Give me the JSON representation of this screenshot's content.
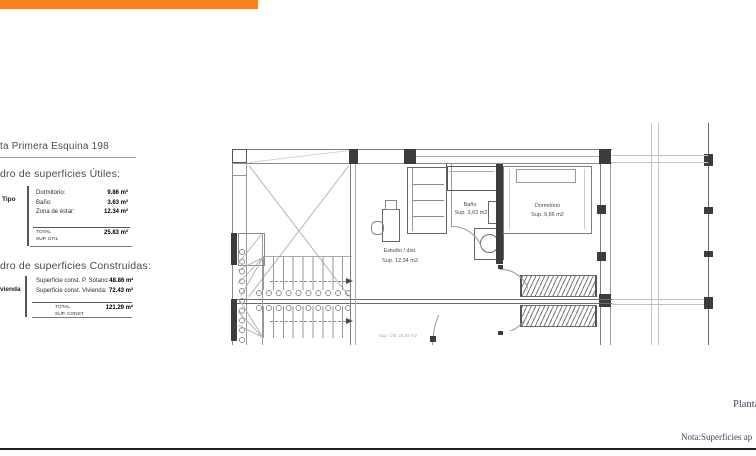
{
  "header": {
    "bar_color": "#F5821F"
  },
  "left_panel": {
    "title": "ta Primera Esquina 198",
    "useful": {
      "heading": "dro de superficies Útiles:",
      "side_label": "Tipo",
      "rows": [
        {
          "label": "Dormitorio:",
          "value": "9.86 m²"
        },
        {
          "label": "Baño:",
          "value": "3.63 m²"
        },
        {
          "label": "Zona de estar:",
          "value": "12.34 m²"
        }
      ],
      "total_label_1": "TOTAL",
      "total_label_2": "SUP. ÚTIL",
      "total_value": "25.83 m²"
    },
    "built": {
      "heading": "dro de superficies Construidas:",
      "side_label": "vienda",
      "rows": [
        {
          "label": "Superficie const. P. Sótano:",
          "value": "48.86 m²"
        },
        {
          "label": "Superficie const. Vivienda:",
          "value": "72.43 m²"
        }
      ],
      "total_label_1": "TOTAL",
      "total_label_2": "SUP. CONST.",
      "total_value": "121.29 m²"
    }
  },
  "plan": {
    "rooms": [
      {
        "name": "bano",
        "label": "Baño",
        "sup": "Sup. 3,63 m2"
      },
      {
        "name": "dormitorio",
        "label": "Dormitorio",
        "sup": "Sup. 9,86 m2"
      },
      {
        "name": "estudio",
        "label": "Estudio / dist.",
        "sup": "Sup. 12,34 m2"
      }
    ],
    "faint_note": "Sup. Útil: 25,83 m2"
  },
  "footer": {
    "plan_label": "Planta",
    "note": "Nota:Superficies ap"
  }
}
